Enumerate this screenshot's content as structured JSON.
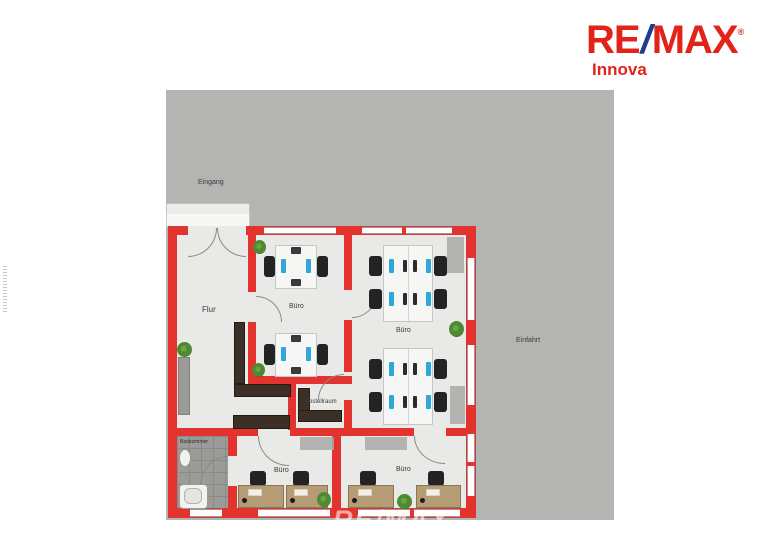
{
  "logo": {
    "brand_re": "RE",
    "brand_slash": "/",
    "brand_max": "MAX",
    "registered": "®",
    "sub_brand": "Innova"
  },
  "watermark": "RE/MAX",
  "floorplan": {
    "outdoor": {
      "entrance": "Eingang",
      "driveway": "Einfahrt"
    },
    "rooms": {
      "hallway": "Flur",
      "office_middle": "Büro",
      "office_large": "Büro",
      "storage": "Abstellraum",
      "office_bottom_left": "Büro",
      "office_bottom_right": "Büro",
      "bathroom": "Badezimmer"
    }
  },
  "colors": {
    "wall_red": "#e2332e",
    "plot_gray": "#b4b4b2",
    "floor": "#e9e9e7",
    "logo_red": "#e2231a",
    "logo_blue": "#1d3d91",
    "wood": "#b59c74",
    "dark_furniture": "#3c2f26",
    "plant_green": "#4e8a33",
    "monitor_blue": "#2da8d8"
  }
}
